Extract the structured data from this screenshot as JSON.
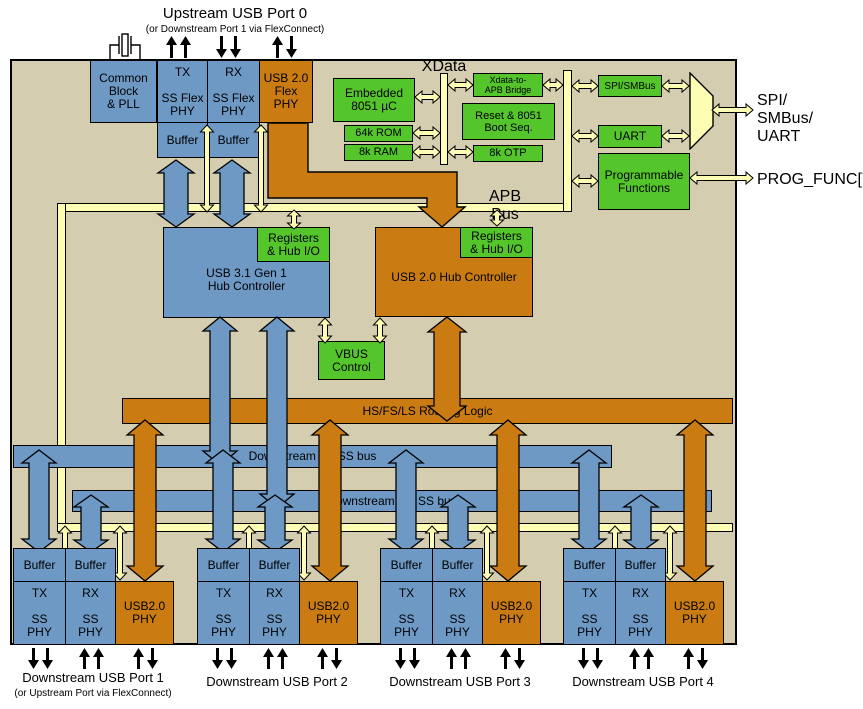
{
  "colors": {
    "chip_bg": "#d5cdb0",
    "blue": "#6d99c4",
    "orange": "#ca7c12",
    "green": "#55c52c",
    "bus_yellow": "#fdfdb4"
  },
  "title": {
    "line1": "Upstream USB Port 0",
    "line2": "(or Downstream Port 1 via FlexConnect)"
  },
  "top_blocks": {
    "common_block": "Common\nBlock\n& PLL",
    "tx_phy": "TX\n\nSS Flex\nPHY",
    "rx_phy": "RX\n\nSS Flex\nPHY",
    "usb2_flex_phy": "USB 2.0\nFlex\nPHY",
    "buffer": "Buffer"
  },
  "cpu": {
    "xdata": "XData",
    "embedded": "Embedded\n8051 µC",
    "rom": "64k ROM",
    "ram": "8k RAM",
    "bridge": "Xdata-to-\nAPB Bridge",
    "reset": "Reset & 8051\nBoot Seq.",
    "otp": "8k OTP"
  },
  "peripherals": {
    "spi": "SPI/SMBus",
    "uart": "UART",
    "prog": "Programmable\nFunctions",
    "io_spi": "SPI/\nSMBus/\nUART",
    "io_prog": "PROG_FUNC[7:1]"
  },
  "apb": {
    "label": "APB Bus"
  },
  "hubs": {
    "registers": "Registers\n& Hub I/O",
    "usb31": "USB 3.1 Gen 1\nHub Controller",
    "usb20": "USB 2.0 Hub Controller",
    "vbus": "VBUS\nControl"
  },
  "buses": {
    "routing": "HS/FS/LS Routing Logic",
    "tx": "Downstream TX SS bus",
    "rx": "Downstream RX SS bus"
  },
  "port_blocks": {
    "buffer": "Buffer",
    "tx": "TX\n\nSS\nPHY",
    "rx": "RX\n\nSS\nPHY",
    "phy": "USB2.0\nPHY"
  },
  "ports": [
    {
      "label": "Downstream USB Port 1",
      "sublabel": "(or Upstream Port via FlexConnect)"
    },
    {
      "label": "Downstream USB Port 2",
      "sublabel": ""
    },
    {
      "label": "Downstream USB Port 3",
      "sublabel": ""
    },
    {
      "label": "Downstream USB Port 4",
      "sublabel": ""
    }
  ]
}
